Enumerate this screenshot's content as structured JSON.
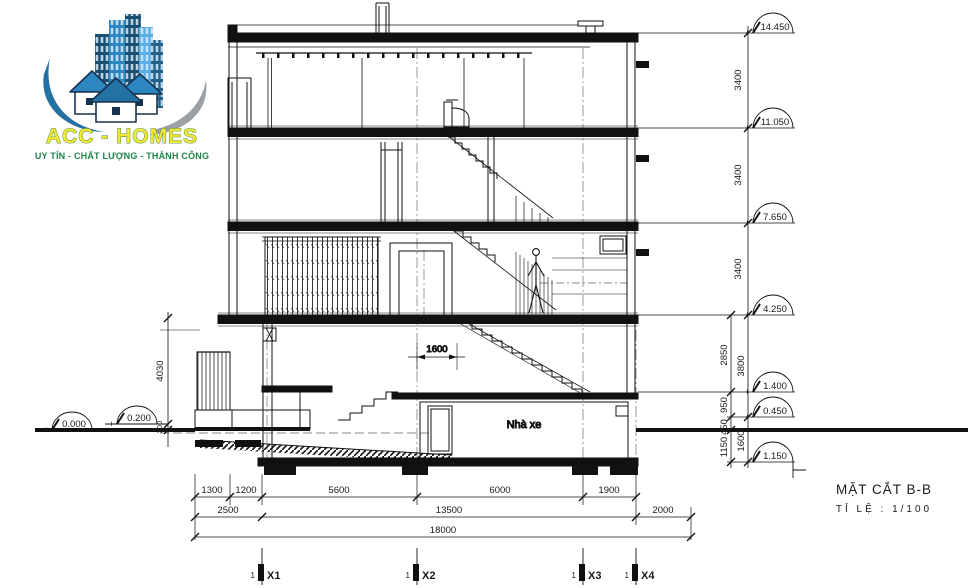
{
  "logo": {
    "brand": "ACC - HOMES",
    "slogan": "UY TÍN - CHẤT LƯỢNG - THÀNH CÔNG",
    "colors": {
      "brand_fill": "#f5e636",
      "brand_outline": "#1e7e34",
      "slogan": "#1e8449",
      "building_dark": "#1b4f72",
      "building_mid": "#2e86c1",
      "building_light": "#aed6f1",
      "swoosh_blue": "#2471a3",
      "swoosh_gray": "#9aa0a6"
    }
  },
  "title": {
    "name": "MẶT CẮT B-B",
    "scale": "TỈ LỆ : 1/100"
  },
  "labels": {
    "garage": "Nhà xe"
  },
  "levels": {
    "right": [
      {
        "sign": "+",
        "value": "14.450"
      },
      {
        "sign": "+",
        "value": "11.050"
      },
      {
        "sign": "+",
        "value": "7.650"
      },
      {
        "sign": "+",
        "value": "4.250"
      },
      {
        "sign": "+",
        "value": "1.400"
      },
      {
        "sign": "+",
        "value": "0.450"
      },
      {
        "sign": "-",
        "value": "1.150"
      }
    ],
    "left": [
      {
        "sign": "+",
        "value": "0.000"
      },
      {
        "sign": "+",
        "value": "0.200"
      }
    ]
  },
  "dims": {
    "vertical_main": [
      "3400",
      "3400",
      "3400",
      "3800",
      "1600"
    ],
    "vertical_secondary": [
      "2850",
      "950",
      "450",
      "1150"
    ],
    "vertical_left": [
      "4030",
      "200"
    ],
    "stair": "1600",
    "row1": [
      "1300",
      "1200",
      "5600",
      "6000",
      "1900"
    ],
    "row2": [
      "2500",
      "13500",
      "2000"
    ],
    "row3": [
      "18000"
    ]
  },
  "axes": [
    {
      "prefix": "1",
      "label": "X1"
    },
    {
      "prefix": "1",
      "label": "X2"
    },
    {
      "prefix": "1",
      "label": "X3"
    },
    {
      "prefix": "1",
      "label": "X4"
    }
  ]
}
